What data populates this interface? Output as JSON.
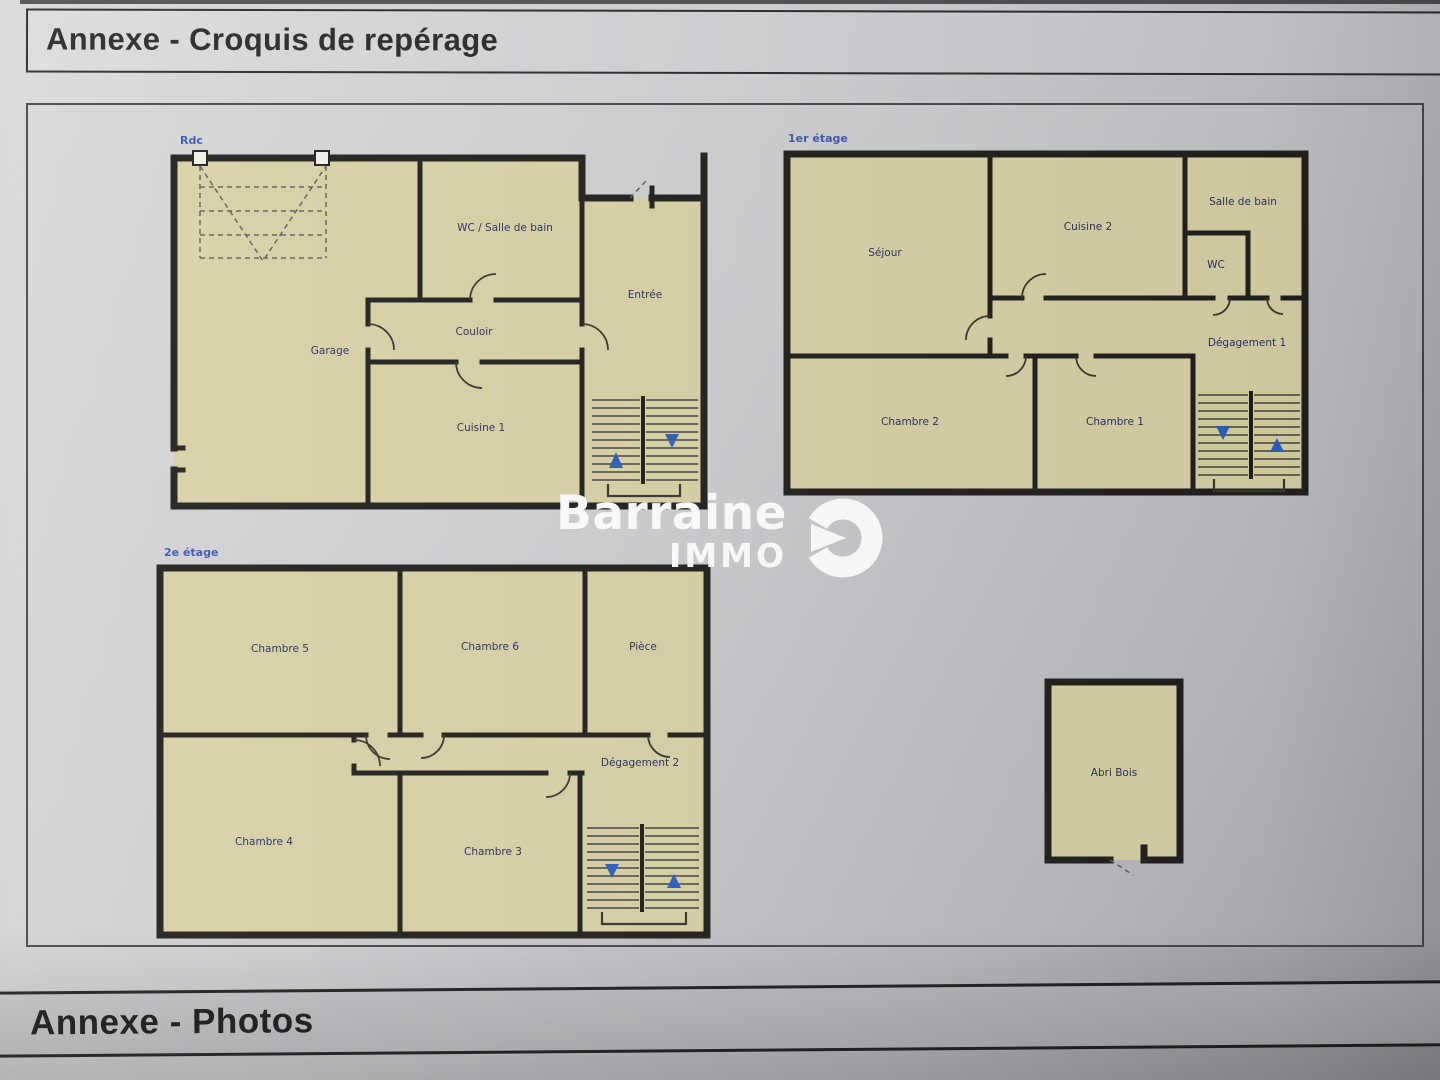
{
  "headers": {
    "top": "Annexe - Croquis de repérage",
    "bottom": "Annexe - Photos"
  },
  "logo": {
    "brand": "Barraine",
    "sub": "IMMO"
  },
  "floors": {
    "rdc": {
      "label": "Rdc",
      "rooms": {
        "garage": "Garage",
        "wc_sdb": "WC / Salle de bain",
        "couloir": "Couloir",
        "cuisine1": "Cuisine 1",
        "entree": "Entrée"
      }
    },
    "etage1": {
      "label": "1er étage",
      "rooms": {
        "sejour": "Séjour",
        "cuisine2": "Cuisine 2",
        "sdb": "Salle de bain",
        "wc": "WC",
        "degagement1": "Dégagement 1",
        "chambre2": "Chambre 2",
        "chambre1": "Chambre 1"
      }
    },
    "etage2": {
      "label": "2e étage",
      "rooms": {
        "chambre5": "Chambre 5",
        "chambre6": "Chambre 6",
        "piece": "Pièce",
        "degagement2": "Dégagement 2",
        "chambre4": "Chambre 4",
        "chambre3": "Chambre 3"
      }
    },
    "outbuilding": {
      "rooms": {
        "abri": "Abri Bois"
      }
    }
  },
  "colors": {
    "paper": "#cfcfd2",
    "room_fill": "#d9d2a7",
    "wall": "#22211e",
    "room_label": "#273262",
    "floor_label": "#3c59ae",
    "stair_arrow": "#2f5fc0",
    "logo": "#ffffff"
  }
}
